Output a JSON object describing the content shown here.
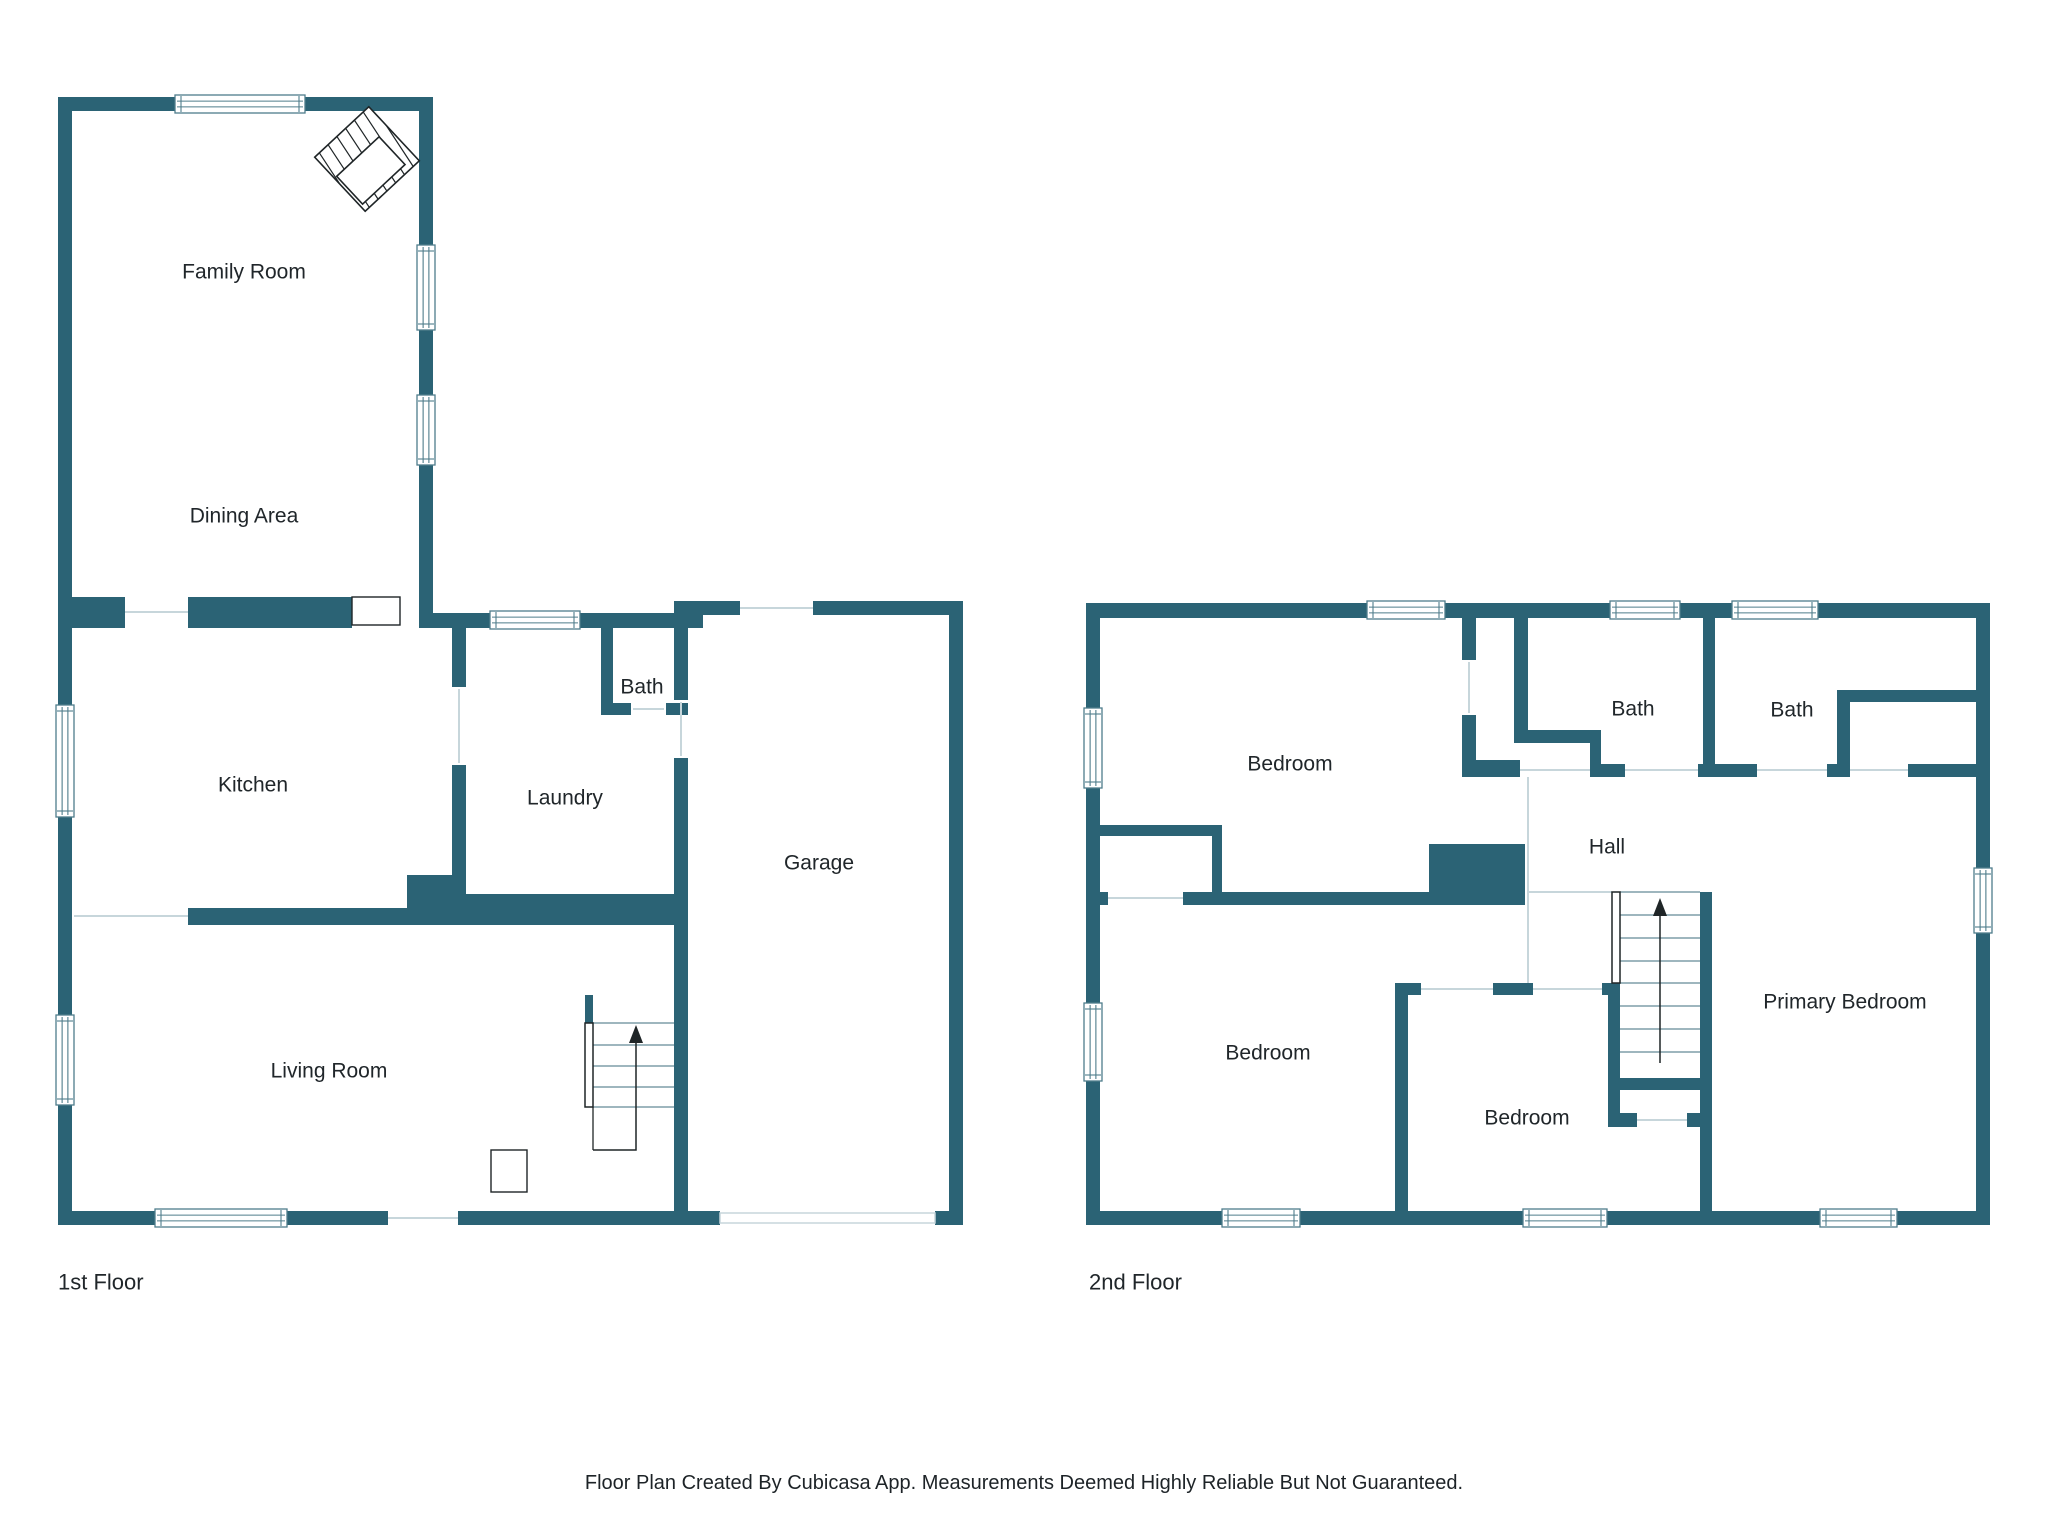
{
  "canvas": {
    "w": 2048,
    "h": 1536
  },
  "colors": {
    "wall": "#2b6375",
    "line": "#c7d6db",
    "stair": "#7f9da8",
    "dark": "#1f2527",
    "winframe": "#4f7d8b",
    "text": "#20262a",
    "floor_fill": "#ffffff"
  },
  "footer": {
    "text": "Floor Plan Created By Cubicasa App. Measurements Deemed Highly Reliable But Not Guaranteed."
  },
  "floors": [
    {
      "id": "first",
      "name": "1st Floor",
      "name_pos": {
        "x": 58,
        "y": 1282
      },
      "rooms": [
        {
          "label": "Family Room",
          "x": 244,
          "y": 272
        },
        {
          "label": "Dining Area",
          "x": 244,
          "y": 516
        },
        {
          "label": "Kitchen",
          "x": 253,
          "y": 785
        },
        {
          "label": "Bath",
          "x": 642,
          "y": 687
        },
        {
          "label": "Laundry",
          "x": 565,
          "y": 798
        },
        {
          "label": "Garage",
          "x": 819,
          "y": 863
        },
        {
          "label": "Living Room",
          "x": 329,
          "y": 1071
        }
      ],
      "walls": [
        [
          58,
          97,
          14,
          1128
        ],
        [
          58,
          97,
          375,
          14
        ],
        [
          419,
          97,
          14,
          531
        ],
        [
          58,
          597,
          67,
          31
        ],
        [
          188,
          597,
          164,
          31
        ],
        [
          433,
          613,
          270,
          15
        ],
        [
          452,
          628,
          14,
          59
        ],
        [
          452,
          765,
          14,
          129
        ],
        [
          601,
          628,
          12,
          87
        ],
        [
          601,
          703,
          30,
          12
        ],
        [
          666,
          703,
          22,
          12
        ],
        [
          674,
          613,
          14,
          87
        ],
        [
          674,
          758,
          14,
          467
        ],
        [
          452,
          894,
          236,
          31
        ],
        [
          188,
          908,
          219,
          17
        ],
        [
          407,
          875,
          59,
          50
        ],
        [
          674,
          601,
          66,
          14
        ],
        [
          813,
          601,
          150,
          14
        ],
        [
          949,
          601,
          14,
          624
        ],
        [
          58,
          1211,
          97,
          14
        ],
        [
          287,
          1211,
          101,
          14
        ],
        [
          458,
          1211,
          230,
          14
        ],
        [
          674,
          1211,
          46,
          14
        ],
        [
          935,
          1211,
          28,
          14
        ],
        [
          585,
          995,
          8,
          28
        ]
      ],
      "windows": [
        [
          175,
          95,
          130,
          18
        ],
        [
          417,
          245,
          18,
          85
        ],
        [
          417,
          395,
          18,
          70
        ],
        [
          490,
          611,
          90,
          18
        ],
        [
          56,
          705,
          18,
          112
        ],
        [
          56,
          1015,
          18,
          90
        ],
        [
          155,
          1209,
          132,
          18
        ]
      ],
      "doors": [
        [
          352,
          597,
          48,
          28
        ],
        [
          491,
          1150,
          36,
          42
        ]
      ],
      "marker_rects": [
        [
          720,
          1213,
          215,
          10
        ]
      ],
      "boundary_lines": [
        [
          125,
          612,
          188,
          612
        ],
        [
          459,
          689,
          459,
          763
        ],
        [
          633,
          709,
          664,
          709
        ],
        [
          681,
          702,
          681,
          756
        ],
        [
          740,
          608,
          813,
          608
        ],
        [
          388,
          1218,
          458,
          1218
        ],
        [
          74,
          916,
          188,
          916
        ]
      ],
      "stair": {
        "treads": [
          [
            593,
            1023,
            674,
            1023
          ],
          [
            593,
            1045,
            674,
            1045
          ],
          [
            593,
            1066,
            674,
            1066
          ],
          [
            593,
            1087,
            674,
            1087
          ],
          [
            593,
            1107,
            674,
            1107
          ]
        ],
        "rails": [
          [
            585,
            1023,
            8,
            84
          ]
        ],
        "path": [
          [
            593,
            1150
          ],
          [
            636,
            1150
          ],
          [
            636,
            1040
          ]
        ],
        "extra_lines": [
          [
            593,
            1107,
            593,
            1150
          ]
        ],
        "arrow": {
          "x": 636,
          "y": 1025,
          "len": 18,
          "half": 7
        }
      },
      "fireplace": {
        "cx": 367,
        "cy": 159,
        "half": 37,
        "rot": -43,
        "inner": [
          -34,
          -8,
          58,
          38
        ],
        "hatch_step": 12
      }
    },
    {
      "id": "second",
      "name": "2nd Floor",
      "name_pos": {
        "x": 1089,
        "y": 1282
      },
      "rooms": [
        {
          "label": "Bedroom",
          "x": 1290,
          "y": 764
        },
        {
          "label": "Bath",
          "x": 1633,
          "y": 709
        },
        {
          "label": "Bath",
          "x": 1792,
          "y": 710
        },
        {
          "label": "Hall",
          "x": 1607,
          "y": 847
        },
        {
          "label": "Bedroom",
          "x": 1268,
          "y": 1053
        },
        {
          "label": "Bedroom",
          "x": 1527,
          "y": 1118
        },
        {
          "label": "Primary Bedroom",
          "x": 1845,
          "y": 1002
        }
      ],
      "walls": [
        [
          1086,
          603,
          904,
          15
        ],
        [
          1086,
          603,
          14,
          622
        ],
        [
          1976,
          603,
          14,
          622
        ],
        [
          1086,
          1211,
          904,
          14
        ],
        [
          1462,
          618,
          14,
          42
        ],
        [
          1462,
          715,
          14,
          45
        ],
        [
          1462,
          760,
          58,
          17
        ],
        [
          1514,
          618,
          14,
          112
        ],
        [
          1514,
          730,
          87,
          13
        ],
        [
          1590,
          743,
          11,
          24
        ],
        [
          1590,
          764,
          35,
          13
        ],
        [
          1703,
          618,
          12,
          146
        ],
        [
          1698,
          764,
          59,
          13
        ],
        [
          1837,
          690,
          13,
          87
        ],
        [
          1850,
          690,
          127,
          12
        ],
        [
          1827,
          764,
          23,
          13
        ],
        [
          1908,
          764,
          82,
          13
        ],
        [
          1429,
          844,
          96,
          61
        ],
        [
          1098,
          825,
          124,
          11
        ],
        [
          1212,
          836,
          10,
          56
        ],
        [
          1098,
          892,
          10,
          13
        ],
        [
          1183,
          892,
          246,
          13
        ],
        [
          1395,
          983,
          26,
          12
        ],
        [
          1493,
          983,
          40,
          12
        ],
        [
          1395,
          995,
          13,
          216
        ],
        [
          1602,
          983,
          18,
          12
        ],
        [
          1608,
          985,
          12,
          142
        ],
        [
          1620,
          1078,
          80,
          12
        ],
        [
          1612,
          1113,
          25,
          14
        ],
        [
          1687,
          1113,
          25,
          14
        ],
        [
          1700,
          892,
          12,
          319
        ]
      ],
      "windows": [
        [
          1367,
          601,
          78,
          18
        ],
        [
          1610,
          601,
          70,
          18
        ],
        [
          1732,
          601,
          86,
          18
        ],
        [
          1084,
          708,
          18,
          80
        ],
        [
          1084,
          1003,
          18,
          78
        ],
        [
          1974,
          868,
          18,
          65
        ],
        [
          1222,
          1209,
          78,
          18
        ],
        [
          1523,
          1209,
          84,
          18
        ],
        [
          1820,
          1209,
          77,
          18
        ]
      ],
      "doors": [],
      "marker_rects": [],
      "boundary_lines": [
        [
          1469,
          662,
          1469,
          713
        ],
        [
          1625,
          770,
          1698,
          770
        ],
        [
          1520,
          770,
          1590,
          770
        ],
        [
          1757,
          770,
          1827,
          770
        ],
        [
          1850,
          770,
          1908,
          770
        ],
        [
          1528,
          777,
          1528,
          983
        ],
        [
          1533,
          989,
          1602,
          989
        ],
        [
          1528,
          892,
          1612,
          892
        ],
        [
          1108,
          898,
          1183,
          898
        ],
        [
          1421,
          989,
          1493,
          989
        ],
        [
          1637,
          1120,
          1687,
          1120
        ]
      ],
      "stair": {
        "treads": [
          [
            1620,
            892,
            1700,
            892
          ],
          [
            1620,
            915,
            1700,
            915
          ],
          [
            1620,
            938,
            1700,
            938
          ],
          [
            1620,
            961,
            1700,
            961
          ],
          [
            1620,
            983,
            1700,
            983
          ],
          [
            1620,
            1006,
            1700,
            1006
          ],
          [
            1620,
            1029,
            1700,
            1029
          ],
          [
            1620,
            1052,
            1700,
            1052
          ]
        ],
        "rails": [
          [
            1612,
            892,
            8,
            91
          ]
        ],
        "path": [
          [
            1660,
            1063
          ],
          [
            1660,
            913
          ]
        ],
        "extra_lines": [],
        "arrow": {
          "x": 1660,
          "y": 898,
          "len": 18,
          "half": 7
        }
      },
      "fireplace": null
    }
  ]
}
